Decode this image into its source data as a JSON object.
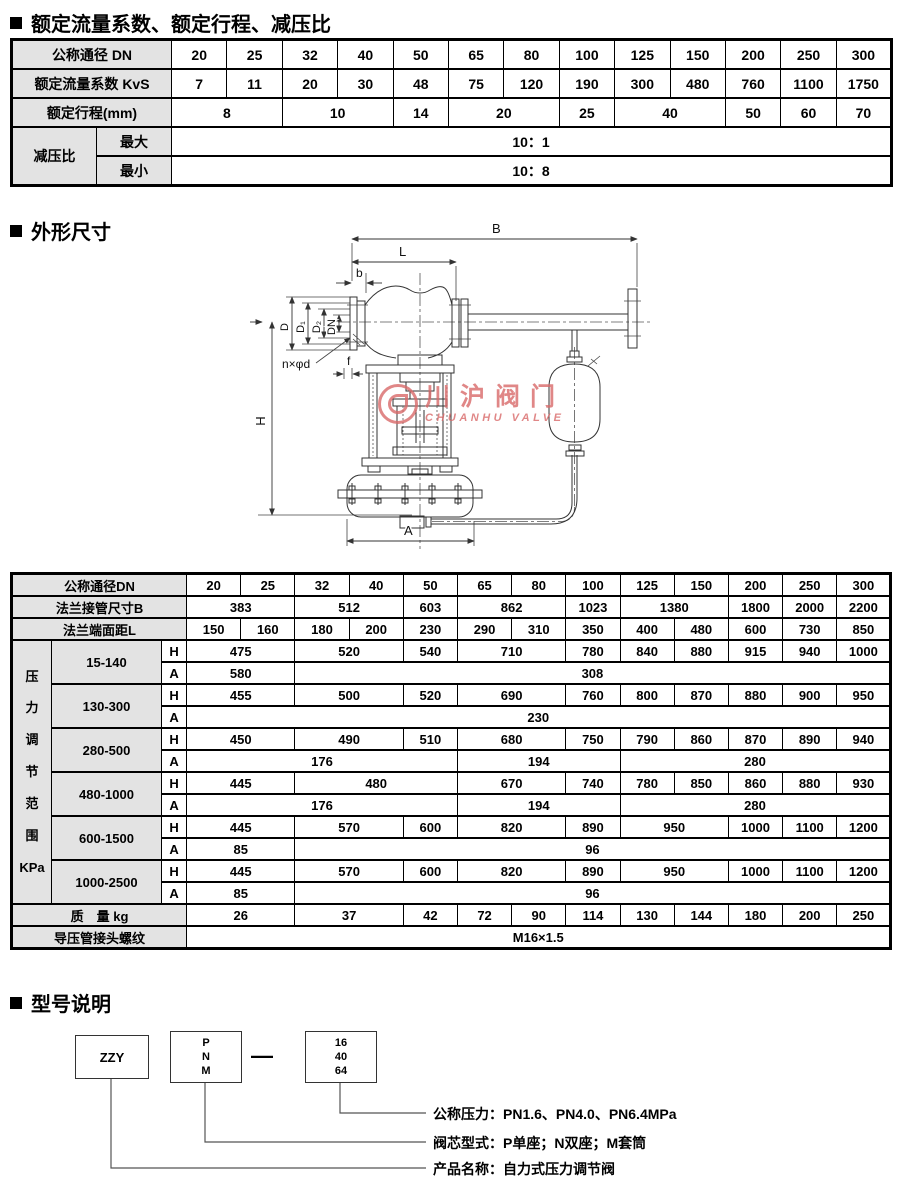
{
  "titles": {
    "t1": "额定流量系数、额定行程、减压比",
    "t2": "外形尺寸",
    "t3": "型号说明"
  },
  "flow_table": {
    "rows": [
      [
        {
          "t": "公称通径 DN",
          "cs": 2,
          "lbl": true
        },
        {
          "t": "20"
        },
        {
          "t": "25"
        },
        {
          "t": "32"
        },
        {
          "t": "40"
        },
        {
          "t": "50"
        },
        {
          "t": "65"
        },
        {
          "t": "80"
        },
        {
          "t": "100"
        },
        {
          "t": "125"
        },
        {
          "t": "150"
        },
        {
          "t": "200"
        },
        {
          "t": "250"
        },
        {
          "t": "300"
        }
      ],
      [
        {
          "t": "额定流量系数 KvS",
          "cs": 2,
          "lbl": true
        },
        {
          "t": "7"
        },
        {
          "t": "11"
        },
        {
          "t": "20"
        },
        {
          "t": "30"
        },
        {
          "t": "48"
        },
        {
          "t": "75"
        },
        {
          "t": "120"
        },
        {
          "t": "190"
        },
        {
          "t": "300"
        },
        {
          "t": "480"
        },
        {
          "t": "760"
        },
        {
          "t": "1100"
        },
        {
          "t": "1750"
        }
      ],
      [
        {
          "t": "额定行程(mm)",
          "cs": 2,
          "lbl": true
        },
        {
          "t": "8",
          "cs": 2
        },
        {
          "t": "10",
          "cs": 2
        },
        {
          "t": "14"
        },
        {
          "t": "20",
          "cs": 2
        },
        {
          "t": "25"
        },
        {
          "t": "40",
          "cs": 2
        },
        {
          "t": "50"
        },
        {
          "t": "60"
        },
        {
          "t": "70"
        }
      ],
      [
        {
          "t": "减压比",
          "rs": 2,
          "lbl": true
        },
        {
          "t": "最大",
          "lbl": true
        },
        {
          "t": "10：1",
          "cs": 13
        }
      ],
      [
        {
          "t": "最小",
          "lbl": true
        },
        {
          "t": "10：8",
          "cs": 13
        }
      ]
    ]
  },
  "drawing_labels": {
    "B": "B",
    "L": "L",
    "b": "b",
    "D": "D",
    "D1": "D₁",
    "D2": "D₂",
    "DN": "DN",
    "nxd": "n×φd",
    "f": "f",
    "H": "H",
    "A": "A"
  },
  "watermark": {
    "cn": "川沪阀门",
    "en": "CHUANHU VALVE"
  },
  "dim_table": {
    "rows": [
      [
        {
          "t": "公称通径DN",
          "cs": 3,
          "lbl": true
        },
        {
          "t": "20"
        },
        {
          "t": "25"
        },
        {
          "t": "32"
        },
        {
          "t": "40"
        },
        {
          "t": "50"
        },
        {
          "t": "65"
        },
        {
          "t": "80"
        },
        {
          "t": "100"
        },
        {
          "t": "125"
        },
        {
          "t": "150"
        },
        {
          "t": "200"
        },
        {
          "t": "250"
        },
        {
          "t": "300"
        }
      ],
      [
        {
          "t": "法兰接管尺寸B",
          "cs": 3,
          "lbl": true
        },
        {
          "t": "383",
          "cs": 2
        },
        {
          "t": "512",
          "cs": 2
        },
        {
          "t": "603"
        },
        {
          "t": "862",
          "cs": 2
        },
        {
          "t": "1023"
        },
        {
          "t": "1380",
          "cs": 2
        },
        {
          "t": "1800"
        },
        {
          "t": "2000"
        },
        {
          "t": "2200"
        }
      ],
      [
        {
          "t": "法兰端面距L",
          "cs": 3,
          "lbl": true
        },
        {
          "t": "150"
        },
        {
          "t": "160"
        },
        {
          "t": "180"
        },
        {
          "t": "200"
        },
        {
          "t": "230"
        },
        {
          "t": "290"
        },
        {
          "t": "310"
        },
        {
          "t": "350"
        },
        {
          "t": "400"
        },
        {
          "t": "480"
        },
        {
          "t": "600"
        },
        {
          "t": "730"
        },
        {
          "t": "850"
        }
      ],
      [
        {
          "t": "压\n力\n调\n节\n范\n围\nKPa",
          "rs": 12,
          "lbl": true,
          "pre": true
        },
        {
          "t": "15-140",
          "rs": 2,
          "lbl": true
        },
        {
          "t": "H"
        },
        {
          "t": "475",
          "cs": 2
        },
        {
          "t": "520",
          "cs": 2
        },
        {
          "t": "540"
        },
        {
          "t": "710",
          "cs": 2
        },
        {
          "t": "780"
        },
        {
          "t": "840"
        },
        {
          "t": "880"
        },
        {
          "t": "915"
        },
        {
          "t": "940"
        },
        {
          "t": "1000"
        }
      ],
      [
        {
          "t": "A"
        },
        {
          "t": "580",
          "cs": 2
        },
        {
          "t": "308",
          "cs": 11
        }
      ],
      [
        {
          "t": "130-300",
          "rs": 2,
          "lbl": true
        },
        {
          "t": "H"
        },
        {
          "t": "455",
          "cs": 2
        },
        {
          "t": "500",
          "cs": 2
        },
        {
          "t": "520"
        },
        {
          "t": "690",
          "cs": 2
        },
        {
          "t": "760"
        },
        {
          "t": "800"
        },
        {
          "t": "870"
        },
        {
          "t": "880"
        },
        {
          "t": "900"
        },
        {
          "t": "950"
        }
      ],
      [
        {
          "t": "A"
        },
        {
          "t": "230",
          "cs": 13
        }
      ],
      [
        {
          "t": "280-500",
          "rs": 2,
          "lbl": true
        },
        {
          "t": "H"
        },
        {
          "t": "450",
          "cs": 2
        },
        {
          "t": "490",
          "cs": 2
        },
        {
          "t": "510"
        },
        {
          "t": "680",
          "cs": 2
        },
        {
          "t": "750"
        },
        {
          "t": "790"
        },
        {
          "t": "860"
        },
        {
          "t": "870"
        },
        {
          "t": "890"
        },
        {
          "t": "940"
        }
      ],
      [
        {
          "t": "A"
        },
        {
          "t": "176",
          "cs": 5
        },
        {
          "t": "194",
          "cs": 3
        },
        {
          "t": "280",
          "cs": 5
        }
      ],
      [
        {
          "t": "480-1000",
          "rs": 2,
          "lbl": true
        },
        {
          "t": "H"
        },
        {
          "t": "445",
          "cs": 2
        },
        {
          "t": "480",
          "cs": 3
        },
        {
          "t": "670",
          "cs": 2
        },
        {
          "t": "740"
        },
        {
          "t": "780"
        },
        {
          "t": "850"
        },
        {
          "t": "860"
        },
        {
          "t": "880"
        },
        {
          "t": "930"
        }
      ],
      [
        {
          "t": "A"
        },
        {
          "t": "176",
          "cs": 5
        },
        {
          "t": "194",
          "cs": 3
        },
        {
          "t": "280",
          "cs": 5
        }
      ],
      [
        {
          "t": "600-1500",
          "rs": 2,
          "lbl": true
        },
        {
          "t": "H"
        },
        {
          "t": "445",
          "cs": 2
        },
        {
          "t": "570",
          "cs": 2
        },
        {
          "t": "600"
        },
        {
          "t": "820",
          "cs": 2
        },
        {
          "t": "890"
        },
        {
          "t": "950",
          "cs": 2
        },
        {
          "t": "1000"
        },
        {
          "t": "1100"
        },
        {
          "t": "1200"
        }
      ],
      [
        {
          "t": "A"
        },
        {
          "t": "85",
          "cs": 2
        },
        {
          "t": "96",
          "cs": 11
        }
      ],
      [
        {
          "t": "1000-2500",
          "rs": 2,
          "lbl": true
        },
        {
          "t": "H"
        },
        {
          "t": "445",
          "cs": 2
        },
        {
          "t": "570",
          "cs": 2
        },
        {
          "t": "600"
        },
        {
          "t": "820",
          "cs": 2
        },
        {
          "t": "890"
        },
        {
          "t": "950",
          "cs": 2
        },
        {
          "t": "1000"
        },
        {
          "t": "1100"
        },
        {
          "t": "1200"
        }
      ],
      [
        {
          "t": "A"
        },
        {
          "t": "85",
          "cs": 2
        },
        {
          "t": "96",
          "cs": 11
        }
      ],
      [
        {
          "t": "质　量 kg",
          "cs": 3,
          "lbl": true
        },
        {
          "t": "26",
          "cs": 2
        },
        {
          "t": "37",
          "cs": 2
        },
        {
          "t": "42"
        },
        {
          "t": "72"
        },
        {
          "t": "90"
        },
        {
          "t": "114"
        },
        {
          "t": "130"
        },
        {
          "t": "144"
        },
        {
          "t": "180"
        },
        {
          "t": "200"
        },
        {
          "t": "250"
        }
      ],
      [
        {
          "t": "导压管接头螺纹",
          "cs": 3,
          "lbl": true
        },
        {
          "t": "M16×1.5",
          "cs": 13
        }
      ]
    ]
  },
  "model": {
    "box1": "ZZY",
    "box2": "P\nN\nM",
    "dash": "—",
    "box3": "16\n40\n64",
    "notes": [
      {
        "text": "公称压力：PN1.6、PN4.0、PN6.4MPa"
      },
      {
        "text": "阀芯型式：P单座；N双座；M套筒"
      },
      {
        "text": "产品名称：自力式压力调节阀"
      }
    ]
  }
}
